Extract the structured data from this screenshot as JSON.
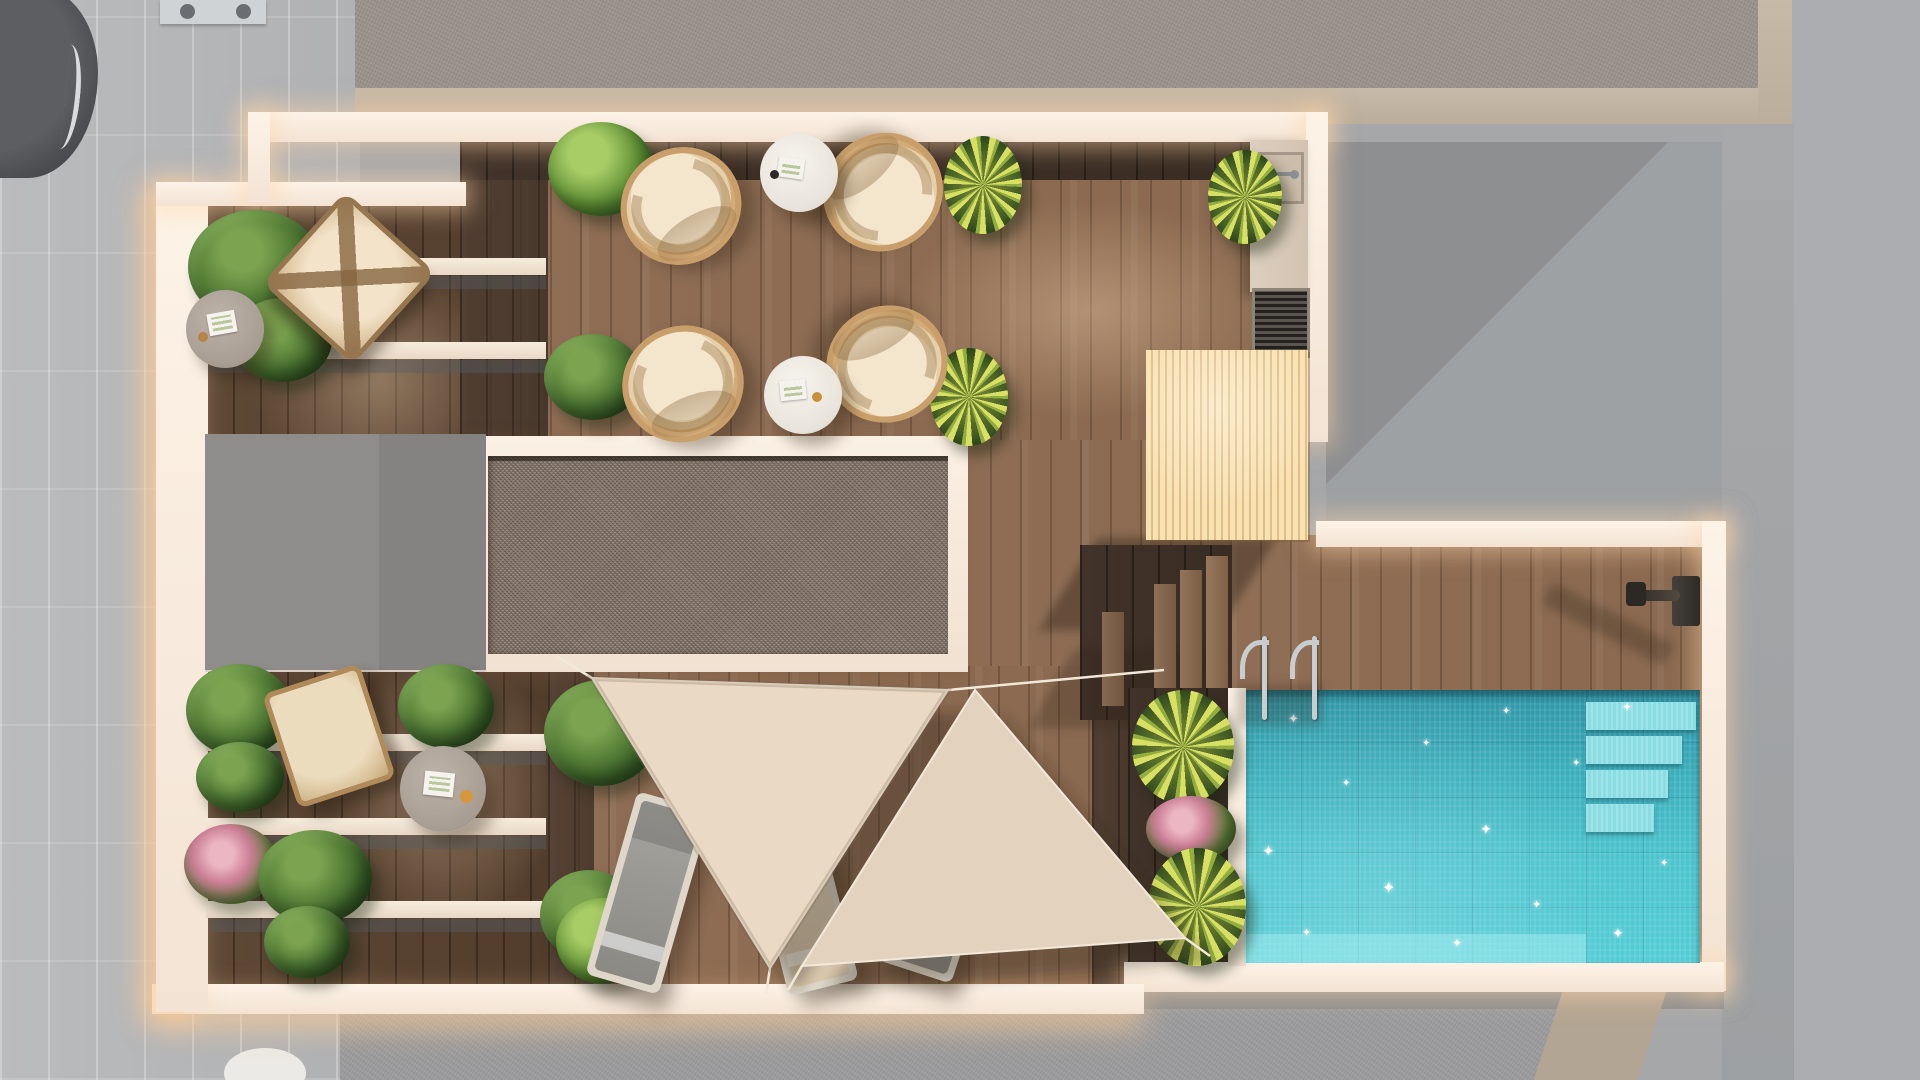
{
  "scene": {
    "label": "Aerial 3D render of a rooftop terrace floor plan",
    "width_px": 1920,
    "height_px": 1080,
    "lighting": "daylight with warm wall glow"
  },
  "palette": {
    "surround_gray": "#a6a7a9",
    "street_tile": "#b6b7b9",
    "roof_texture": "#99928c",
    "roof_texture_dark": "#9c9c9e",
    "tan_parapet": "#c0b3a1",
    "wall_white": "#f8ecdf",
    "deck_wood": "#8d6b53",
    "dark_wood": "#41322a",
    "wing_wood": "#5e4836",
    "gravel": "#8b7b6e",
    "gray_roof_box": "#8f8d8c",
    "slat_wood": "#f3d9a8",
    "pool_teal_dark": "#2f95a6",
    "pool_turquoise": "#52c8d2",
    "pool_step": "#8adde3",
    "sail_cream": "#ead9c5",
    "lounger_gray": "#93928d",
    "lounger_cream": "#e9dbc7",
    "wicker_tan": "#cfa877",
    "cushion_cream": "#f2e3cb",
    "plant_green": "#4c7a35",
    "plant_yellow_green": "#cfd85e",
    "flower_pink": "#d898ab",
    "kitchen_counter": "#d9cabb",
    "grill_dark": "#4a443e",
    "metal": "#c8cdd0"
  },
  "surroundings": {
    "left_street": {
      "label": "Street with stone paving"
    },
    "parked_car": {
      "label": "Parked car roof"
    },
    "ac_unit": {
      "label": "Rooftop vent unit"
    },
    "upper_roof": {
      "label": "Neighbouring textured roof (top)"
    },
    "lower_roof": {
      "label": "Neighbouring textured roof (bottom)"
    },
    "right_area": {
      "label": "Neighbouring flat roof (right)"
    }
  },
  "terrace": {
    "label": "Rooftop terrace",
    "walls_label": "White parapet walls",
    "zones": [
      {
        "id": "pergola_wing",
        "label": "Pergola wing with slatted white beams"
      },
      {
        "id": "lounge_deck",
        "label": "Main timber deck with wicker chairs"
      },
      {
        "id": "gravel_roof",
        "label": "Gravel roof section with cream border"
      },
      {
        "id": "roof_box",
        "label": "Flat grey roof box"
      },
      {
        "id": "outdoor_kitchen",
        "label": "Outdoor kitchen with sink and grill"
      },
      {
        "id": "timber_volume",
        "label": "Slatted light-timber volume"
      },
      {
        "id": "stairs",
        "label": "Timber steps down to pool deck"
      },
      {
        "id": "sail_deck",
        "label": "Deck shaded by two sail canopies"
      },
      {
        "id": "pool_deck",
        "label": "Pool deck"
      },
      {
        "id": "pool",
        "label": "Swimming pool with entry steps",
        "water_colors": [
          "#2f95a6",
          "#52c8d2"
        ],
        "has_ladder": true,
        "has_outdoor_shower": true
      }
    ]
  },
  "objects": {
    "wicker_chairs": {
      "label": "Round wicker lounge chair",
      "count": 4
    },
    "side_tables": {
      "label": "Round white side table with tray",
      "count": 2
    },
    "wing_tables": {
      "label": "Round taupe coffee table",
      "count": 2
    },
    "butterfly_chair": {
      "label": "Butterfly chair with cream cushion",
      "count": 1
    },
    "low_wood_chair": {
      "label": "Low wooden lounge chair",
      "count": 1
    },
    "sun_loungers": {
      "label": "Sun lounger",
      "count": 3
    },
    "shade_sails": {
      "label": "Triangular cream shade sail",
      "count": 2
    },
    "pool_ladder": {
      "label": "Stainless pool ladder",
      "count": 1
    },
    "outdoor_shower": {
      "label": "Wall-mounted outdoor shower",
      "count": 1
    },
    "grill": {
      "label": "Built-in grill",
      "count": 1
    },
    "sink": {
      "label": "Counter sink with faucet",
      "count": 1
    }
  },
  "plants": {
    "label": "Terrace planting",
    "types": [
      "leafy shrub",
      "yucca",
      "flowering pink shrub",
      "boxwood ball"
    ],
    "count": 19
  }
}
